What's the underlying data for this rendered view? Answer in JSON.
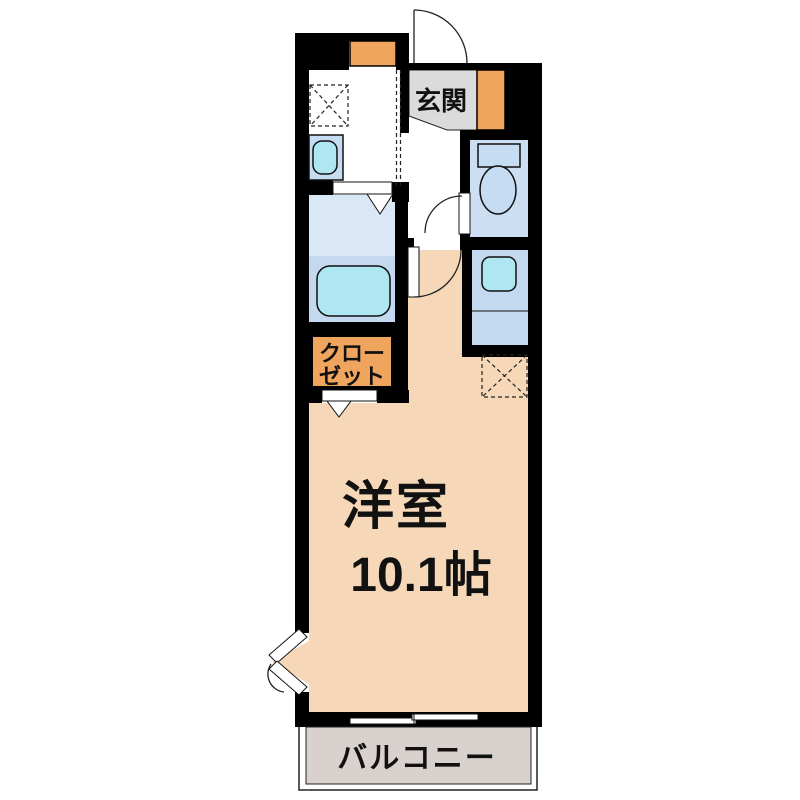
{
  "floorplan": {
    "title": "1K apartment floor plan",
    "entrance_label": "玄関",
    "closet": {
      "line1": "クロー",
      "line2": "ゼット"
    },
    "main_room": {
      "name": "洋室",
      "size": "10.1帖"
    },
    "balcony_label": "バルコニー",
    "colors": {
      "wall": "#000000",
      "room_floor": "#F6D8B8",
      "accent_orange": "#F0A55F",
      "entrance_gray": "#DBDBDB",
      "balcony_gray": "#D8D1CD",
      "washroom_blue": "#D9E7F6",
      "bath_blue": "#C4D8EF",
      "toilet_blue": "#CBDEF2",
      "laundry_blue": "#C3D9EF",
      "fixture_cyan": "#AEE6F2",
      "fixture_blue": "#C6DCF2"
    }
  }
}
